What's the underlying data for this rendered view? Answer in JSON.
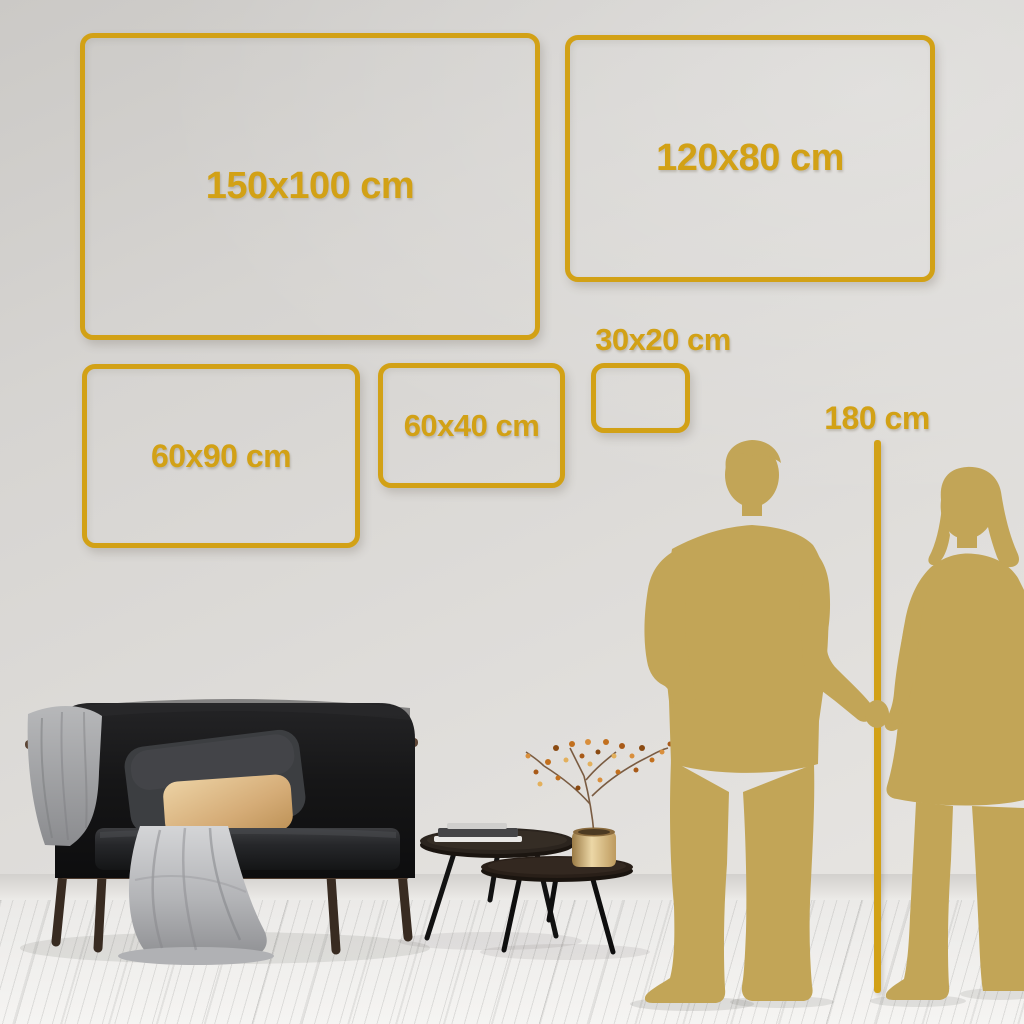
{
  "size_guide": {
    "frames": [
      {
        "id": "150x100",
        "label": "150x100 cm"
      },
      {
        "id": "120x80",
        "label": "120x80 cm"
      },
      {
        "id": "30x20",
        "label": "30x20 cm"
      },
      {
        "id": "60x40",
        "label": "60x40 cm"
      },
      {
        "id": "60x90",
        "label": "60x90 cm"
      }
    ],
    "height_marker": {
      "label": "180 cm"
    }
  },
  "colors": {
    "frame_gold": "#d2a116",
    "silhouette_gold": "#c2a557",
    "wall": "#d9d7d3",
    "floor": "#f1f0ee"
  },
  "scene": {
    "silhouettes": [
      "man",
      "woman"
    ],
    "furniture": [
      "dark-velvet-sofa",
      "gray-blanket",
      "gray-throw",
      "dark-pillow",
      "beige-pillow",
      "nesting-coffee-tables",
      "book-stack",
      "brass-vase",
      "dried-branch"
    ]
  }
}
